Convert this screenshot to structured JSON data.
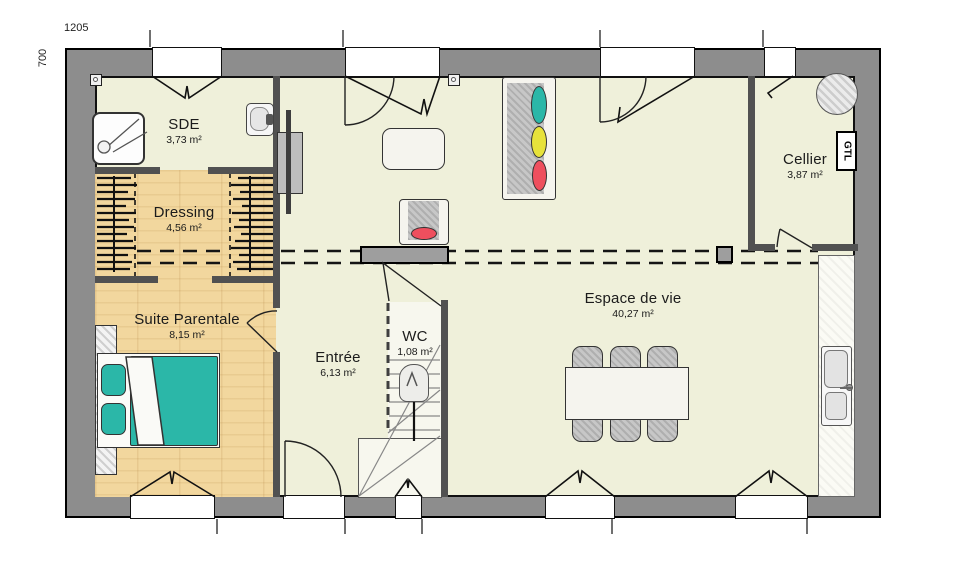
{
  "plan": {
    "dimension_width": "1205",
    "dimension_height": "700",
    "gtl": "GTL"
  },
  "rooms": {
    "sde": {
      "name": "SDE",
      "area": "3,73 m²"
    },
    "dressing": {
      "name": "Dressing",
      "area": "4,56 m²"
    },
    "suite_parentale": {
      "name": "Suite Parentale",
      "area": "8,15 m²"
    },
    "entree": {
      "name": "Entrée",
      "area": "6,13 m²"
    },
    "wc": {
      "name": "WC",
      "area": "1,08 m²"
    },
    "espace_de_vie": {
      "name": "Espace de vie",
      "area": "40,27 m²"
    },
    "cellier": {
      "name": "Cellier",
      "area": "3,87 m²"
    }
  },
  "icons": [
    "shower-icon",
    "washbasin-icon",
    "toilet-icon",
    "double-bed-icon",
    "sofa-icon",
    "armchair-icon",
    "coffee-table-icon",
    "dining-table-icon",
    "chair-icon",
    "kitchen-sink-icon",
    "water-heater-icon",
    "tv-icon",
    "ceiling-light-icon",
    "stairs-icon",
    "wardrobe-rail-icon"
  ],
  "colors": {
    "wall": "#8d8d8d",
    "floor": "#eff0da",
    "wood": "#f2d79e",
    "teal": "#2bb7a8",
    "yellow": "#e7e23b",
    "red": "#ee4f5e",
    "partition": "#515151"
  }
}
